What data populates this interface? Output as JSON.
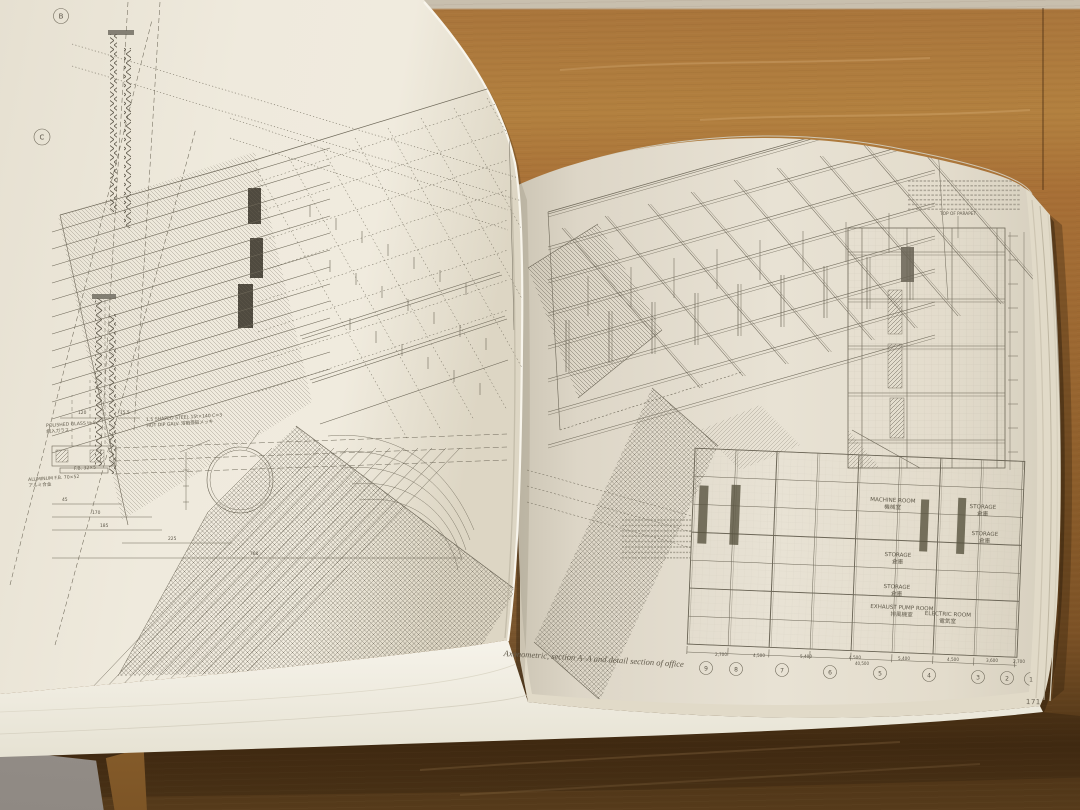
{
  "photo": {
    "caption": "Axonometric, section A–A and detail section of office",
    "page_number": "171"
  },
  "leftPage": {
    "grid_letters": [
      "B",
      "C"
    ],
    "top_dims": [
      "120",
      "15.5"
    ],
    "annotations": {
      "glass": "POLISHED GLASS t=8\n網入ガラス",
      "steel": "1.5 SHAPED STEEL 15t×140 C=3\nHOT DIP GALV. 溶融亜鉛メッキ",
      "alum": "ALUMINUM F.B. 70×52\nアルミ合金",
      "fb": "F.B. 32×5"
    },
    "detail_dims": [
      "45",
      "170",
      "185",
      "225",
      "760"
    ]
  },
  "rightPage": {
    "parapet_label": "TOP OF PARAPET",
    "rooms": {
      "machine": "MACHINE ROOM\n機械室",
      "storage1": "STORAGE\n倉庫",
      "storage2": "STORAGE\n倉庫",
      "storage3": "STORAGE\n倉庫",
      "storage4": "STORAGE\n倉庫",
      "pump": "EXHAUST PUMP ROOM\n排風機室",
      "electric": "ELECTRIC ROOM\n電気室"
    },
    "grid": [
      "9",
      "8",
      "7",
      "6",
      "5",
      "4",
      "3",
      "2",
      "1"
    ],
    "dims": [
      "2,700",
      "4,500",
      "5,400",
      "4,500",
      "5,400",
      "4,500",
      "3,600",
      "2,700"
    ],
    "total_dim": "40,500"
  }
}
